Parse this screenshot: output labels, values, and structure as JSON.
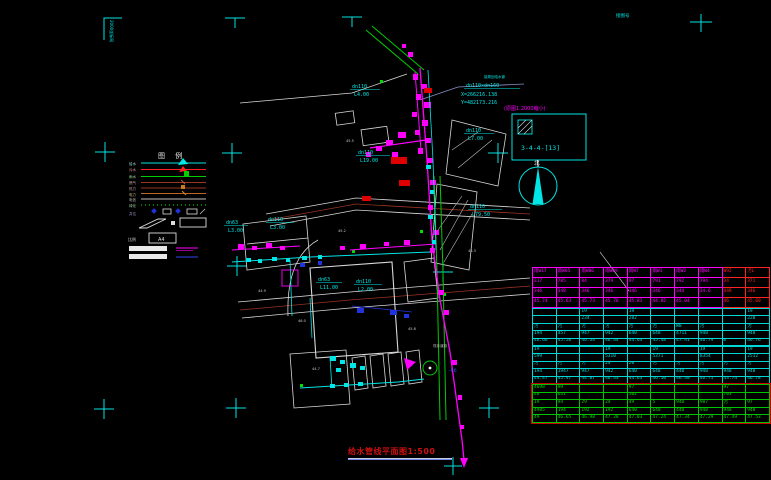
{
  "sheet": {
    "corner_note_left": "2000坐标网",
    "corner_note_right": "接图号",
    "title": "给水管线平面图1:500"
  },
  "colors": {
    "water_cyan": "#00e5e5",
    "sewer_magenta": "#ff00ff",
    "storm_green": "#00cc00",
    "gas_brown": "#993322",
    "power_blue": "#2233dd",
    "alert_red": "#e00000",
    "title_red": "#cc1111",
    "white": "#e8e8e8"
  },
  "legend": {
    "title": "图 例",
    "items": [
      {
        "label": "给水",
        "color": "#00e5e5"
      },
      {
        "label": "污水",
        "color": "#ff2222"
      },
      {
        "label": "雨水",
        "color": "#00cc00"
      },
      {
        "label": "燃气",
        "color": "#993322"
      },
      {
        "label": "热力",
        "color": "#993322"
      },
      {
        "label": "电力",
        "color": "#bb6622"
      },
      {
        "label": "电信",
        "color": "#999999"
      },
      {
        "label": "绿化",
        "color": "#00bb00"
      },
      {
        "label": "井位",
        "color": "#2233cc"
      }
    ],
    "scale_label": "比例",
    "a4_label": "A4"
  },
  "callout": {
    "line0": "接规划给水管",
    "line1": "dn110×dn160",
    "line2": "X=266216.138",
    "line3": "Y=482173.216"
  },
  "detail": {
    "note": "(原图1:2000缩小)",
    "ref": "3-4-4-[13]"
  },
  "north_label": "北",
  "misc": {
    "r6": "-R6",
    "road": "现状道路"
  },
  "spots": [
    {
      "v": "45.2"
    },
    {
      "v": "46.0"
    },
    {
      "v": "45.8"
    },
    {
      "v": "44.9"
    },
    {
      "v": "46.3"
    },
    {
      "v": "45.5"
    },
    {
      "v": "44.7"
    }
  ],
  "pipe_labels": [
    {
      "size": "dn110",
      "len": "L4.00"
    },
    {
      "size": "dn110",
      "len": "L7.00"
    },
    {
      "size": "dn110",
      "len": "L19.00"
    },
    {
      "size": "dn110",
      "len": "L79.50"
    },
    {
      "size": "dn63",
      "len": "L3.00"
    },
    {
      "size": "dn110",
      "len": "L3.00"
    },
    {
      "size": "dn63",
      "len": "L11.00"
    },
    {
      "size": "dn110",
      "len": "L2.00"
    }
  ],
  "table": {
    "red": "#ff2222",
    "sections": [
      {
        "border": "#ff00ff",
        "text": "#ff00ff",
        "red_cols": [
          8,
          9
        ],
        "row_h": 9,
        "rows": [
          [
            "雨W17",
            "雨W05",
            "雨W06",
            "雨W09",
            "雨W7",
            "雨W1",
            "雨W2",
            "雨W4",
            "W92",
            "污L"
          ],
          [
            "317",
            "785",
            "84",
            "379",
            "97",
            "791",
            "792",
            "794",
            "34",
            "371"
          ],
          [
            "346",
            "348",
            "346",
            "346",
            "346",
            "346",
            "344",
            "34.6",
            "44R",
            "346"
          ],
          [
            "45.74",
            "45.63",
            "45.73",
            "45.76",
            "45.81",
            "44.82",
            "45.04",
            "",
            "46",
            "45.60"
          ]
        ]
      },
      {
        "border": "#00d8d8",
        "text": "#00d8d8",
        "row_h": 6.4,
        "rows": [
          [
            "",
            "",
            "19",
            "",
            "19",
            "",
            "",
            "",
            "",
            "19"
          ],
          [
            "",
            "",
            "234",
            "",
            "282",
            "",
            "",
            "",
            "",
            "228"
          ],
          [
            "污",
            "污",
            "污",
            "污",
            "污",
            "污",
            "W0",
            "污",
            "",
            "污"
          ],
          [
            "194",
            "457",
            "947",
            "942",
            "640",
            "648",
            "4711",
            "948",
            "",
            "948"
          ],
          [
            "46.66",
            "45.56",
            "46.34",
            "46.44",
            "44.64",
            "45.48",
            "47.41",
            "46.79",
            "m",
            "46.76"
          ]
        ]
      },
      {
        "border": "#00d8d8",
        "text": "#00d8d8",
        "row_h": 6.4,
        "rows": [
          [
            "19",
            "",
            "",
            "19",
            "",
            "19",
            "",
            "19",
            "",
            "19"
          ],
          [
            "599",
            "",
            "",
            "5310",
            "",
            "5371",
            "",
            "8354",
            "",
            "2512"
          ],
          [
            "污",
            "污",
            "污",
            "24",
            "20",
            "污",
            "污",
            "污",
            "污",
            "污"
          ],
          [
            "194",
            "1947",
            "947",
            "942",
            "640",
            "648",
            "440",
            "948",
            "948",
            "948"
          ],
          [
            "44.47",
            "45.47",
            "44.07",
            "46.43",
            "44.63",
            "46.10",
            "46.40",
            "46.71",
            "43.74",
            "46.78"
          ]
        ]
      },
      {
        "border": "#00c400",
        "text": "#00dd00",
        "outer": "#cc0000",
        "row_h": 6.6,
        "rows": [
          [
            "4698",
            "99",
            "",
            "",
            "97",
            "",
            "",
            "",
            "97",
            ""
          ],
          [
            "46",
            "D31",
            "",
            "",
            "502",
            "",
            "",
            "",
            "703",
            ""
          ],
          [
            "19",
            "94",
            "29",
            "24",
            "49",
            "5",
            "940",
            "987",
            "污",
            "97"
          ],
          [
            "4985",
            "194",
            "192",
            "192",
            "640",
            "648",
            "440",
            "948",
            "948",
            "948"
          ],
          [
            "49",
            "46.65",
            "46.98",
            "47.28",
            "47.03",
            "47.24",
            "47.34",
            "47.29",
            "47.49",
            "47.53"
          ]
        ]
      }
    ]
  }
}
